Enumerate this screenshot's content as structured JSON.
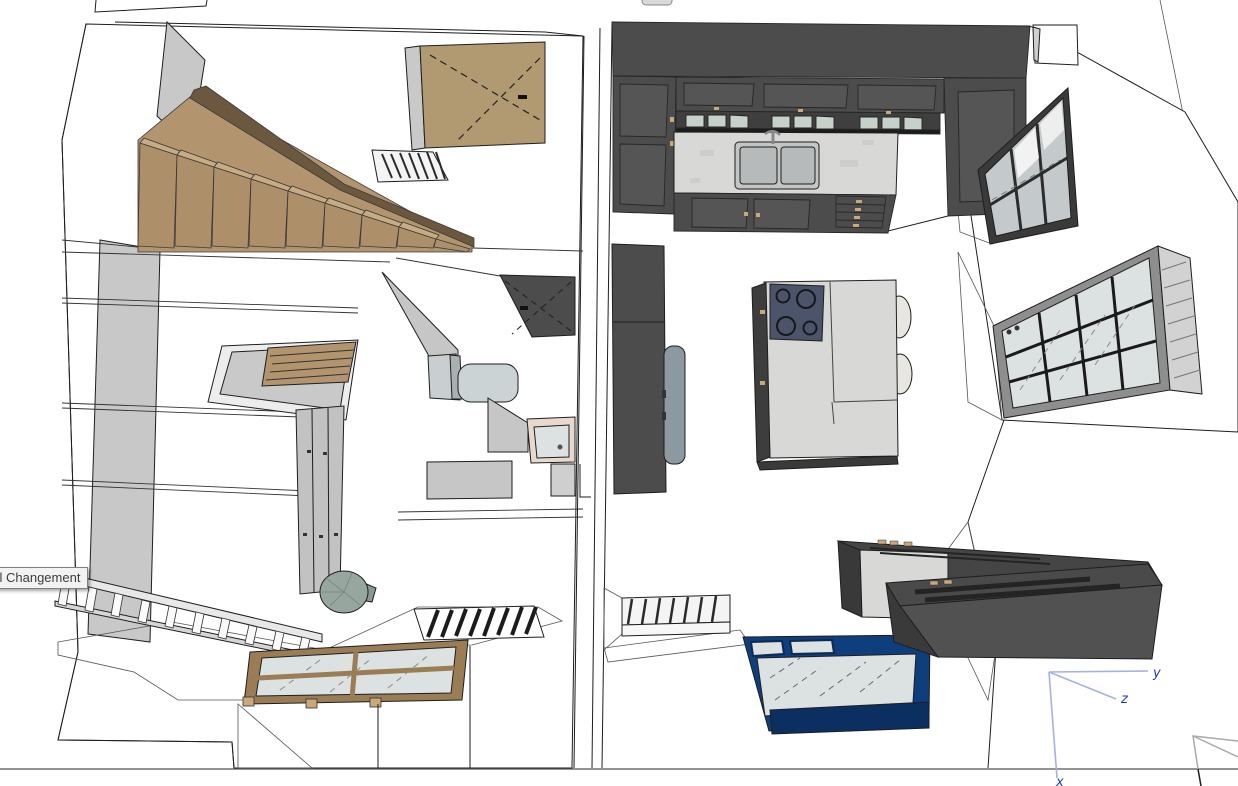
{
  "app": {
    "type": "3d-modeler-viewport",
    "tooltip_text": "til Changement"
  },
  "axes": {
    "x_label": "x",
    "y_label": "y",
    "z_label": "z"
  },
  "colors": {
    "background": "#ffffff",
    "outline": "#1e1e1e",
    "wall_white": "#ffffff",
    "wall_shade": "#c8c8c8",
    "wall_shade_light": "#dcdcdc",
    "wood": "#b2946e",
    "wood_dark_stringer": "#6b583f",
    "wood_tread_top": "#c7ab82",
    "wood_riser": "#ad8f6a",
    "wood_door": "#b19971",
    "wood_frame": "#9b7d55",
    "cabinet_dark": "#4c4c4c",
    "cabinet_panel": "#555555",
    "cabinet_side": "#3a3a3a",
    "marble": "#d8d8d6",
    "glass": "#dce1e1",
    "glass_green": "#c6d2c9",
    "steel_window_frame": "#3a3a3a",
    "window_frame_gray": "#8e8e8e",
    "blue_frame": "#0f3e7d",
    "blue_frame_dark": "#0a2f60",
    "cooktop": "#4b5468",
    "ceramic": "#ccd3d5",
    "radiator": "#f4f4f4",
    "cylinder": "#98a6a0",
    "appliance_gray": "#8d99a1",
    "axis_line": "#a3b2e0",
    "axis_label": "#1f3da6",
    "tooltip_bg": "#f2f2f2",
    "tooltip_border": "#808080",
    "tooltip_text_color": "#3c3c3c"
  },
  "scene_objects": [
    "wood-staircase",
    "wood-door",
    "hall-radiator",
    "stairwell-opening",
    "closet-doors",
    "bathroom-door",
    "toilet",
    "bathroom-sink",
    "stair-railing",
    "water-cylinder",
    "wood-glass-panel",
    "floor-grate",
    "kitchen-wall-cabinets",
    "kitchen-counter",
    "kitchen-sink",
    "kitchen-island",
    "cooktop",
    "bar-stools",
    "fridge-column",
    "steel-window",
    "large-window",
    "kitchen-radiator",
    "blue-glass-door",
    "dark-sideboard",
    "axis-gizmo"
  ]
}
